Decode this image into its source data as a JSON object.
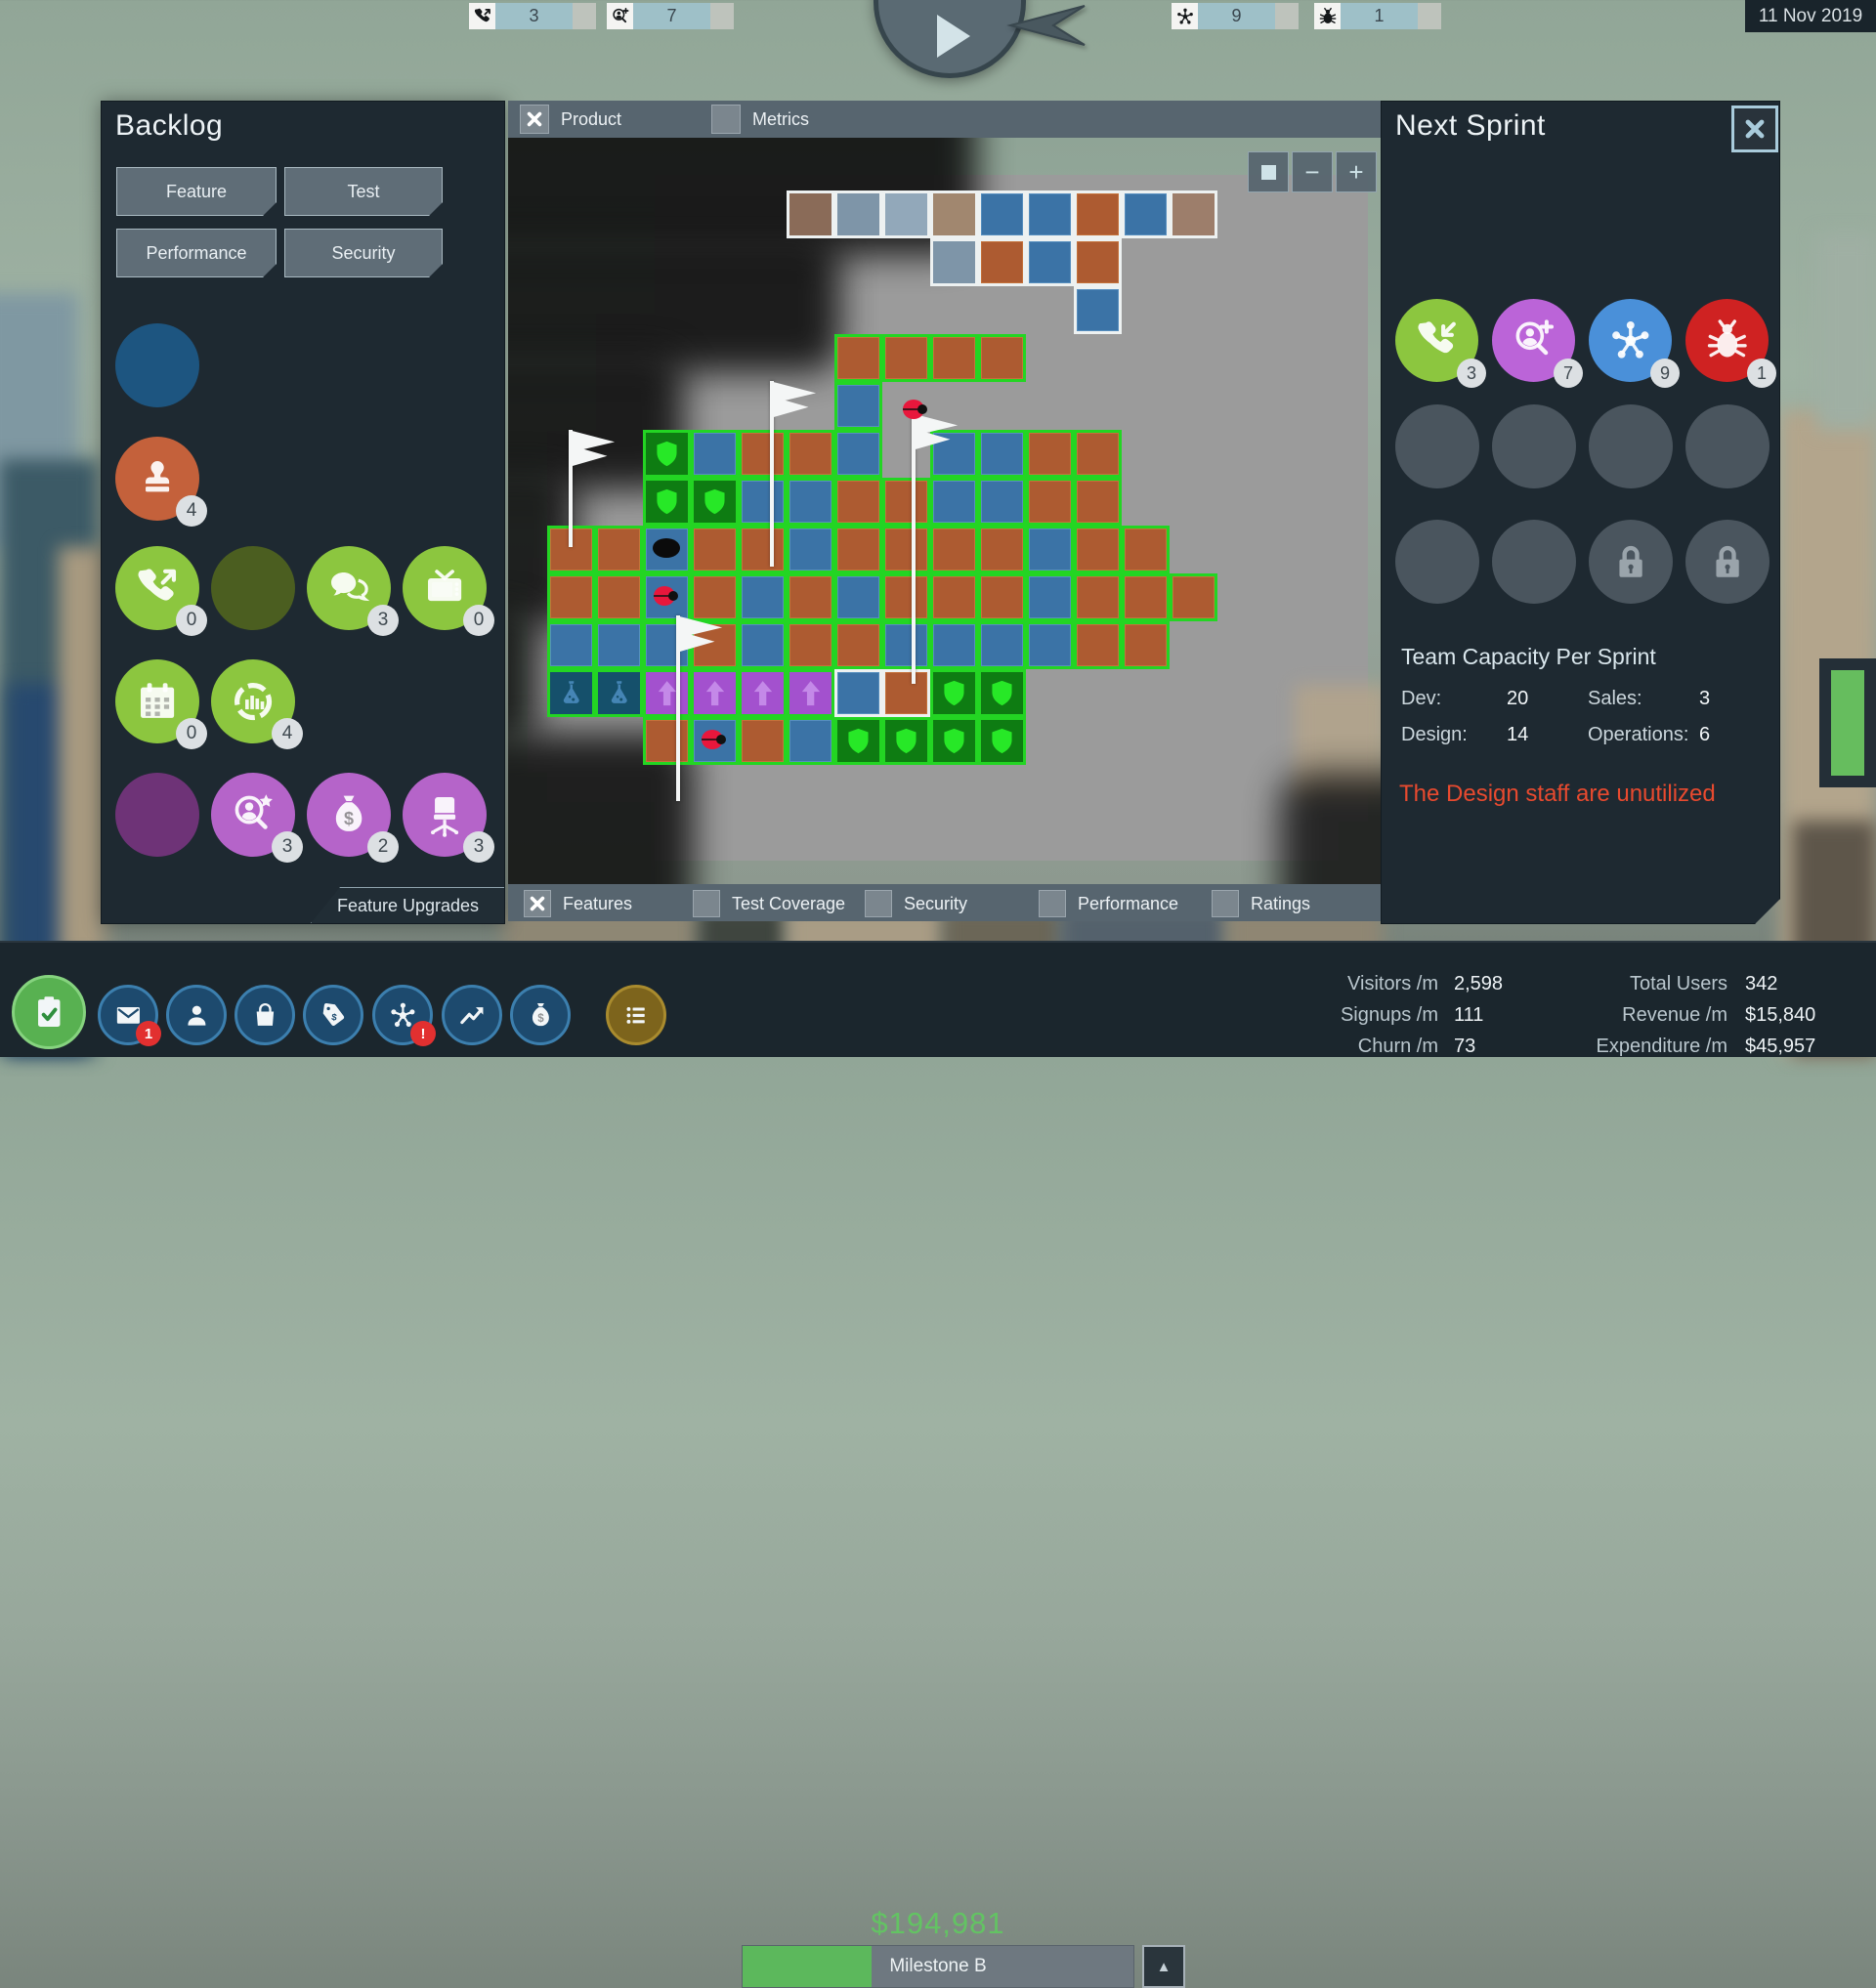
{
  "top_bar": {
    "date": "11 Nov 2019",
    "counters": [
      {
        "icon": "phone-out-icon",
        "value": "3"
      },
      {
        "icon": "person-add-icon",
        "value": "7"
      },
      {
        "icon": "network-icon",
        "value": "9"
      },
      {
        "icon": "bug-icon",
        "value": "1"
      }
    ]
  },
  "backlog": {
    "title": "Backlog",
    "buttons": [
      "Feature",
      "Test",
      "Performance",
      "Security"
    ],
    "rows": [
      [
        {
          "icon": "",
          "color": "#1D5580"
        }
      ],
      [
        {
          "icon": "stamp-icon",
          "color": "#C4613B",
          "badge": "4"
        }
      ],
      [
        {
          "icon": "phone-out-icon",
          "color": "#8CC63F",
          "badge": "0"
        },
        {
          "icon": "",
          "color": "#4B5E20"
        },
        {
          "icon": "chat-icon",
          "color": "#8CC63F",
          "badge": "3"
        },
        {
          "icon": "tv-icon",
          "color": "#8CC63F",
          "badge": "0"
        }
      ],
      [
        {
          "icon": "calendar-icon",
          "color": "#8CC63F",
          "badge": "0"
        },
        {
          "icon": "chart-icon",
          "color": "#8CC63F",
          "badge": "4"
        }
      ],
      [
        {
          "icon": "",
          "color": "#6E3377"
        },
        {
          "icon": "person-star-icon",
          "color": "#B564C9",
          "badge": "3"
        },
        {
          "icon": "moneybag-icon",
          "color": "#B564C9",
          "badge": "2"
        },
        {
          "icon": "chair-icon",
          "color": "#B564C9",
          "badge": "3"
        }
      ]
    ],
    "footer_tab": "Feature Upgrades"
  },
  "map": {
    "tabs": [
      {
        "label": "Product",
        "checked": true
      },
      {
        "label": "Metrics",
        "checked": false
      }
    ],
    "legend": [
      {
        "label": "Features",
        "checked": true
      },
      {
        "label": "Test Coverage",
        "checked": false
      },
      {
        "label": "Security",
        "checked": false
      },
      {
        "label": "Performance",
        "checked": false
      },
      {
        "label": "Ratings",
        "checked": false
      }
    ],
    "zoom_buttons": [
      "center",
      "minus",
      "plus"
    ],
    "grid": {
      "cell": 49,
      "ox": 40,
      "oy": 54,
      "white": [
        [
          5,
          0,
          "fbr"
        ],
        [
          6,
          0,
          "fbl"
        ],
        [
          7,
          0,
          "flb"
        ],
        [
          8,
          0,
          "ftn"
        ],
        [
          9,
          0,
          "bl"
        ],
        [
          10,
          0,
          "bl"
        ],
        [
          11,
          0,
          "br"
        ],
        [
          12,
          0,
          "bl"
        ],
        [
          13,
          0,
          "fb2"
        ],
        [
          8,
          1,
          "fbl"
        ],
        [
          9,
          1,
          "br"
        ],
        [
          10,
          1,
          "bl"
        ],
        [
          11,
          1,
          "br"
        ],
        [
          11,
          2,
          "bl"
        ],
        [
          6,
          10,
          "bl"
        ],
        [
          7,
          10,
          "br"
        ]
      ],
      "green": [
        [
          6,
          3,
          "br"
        ],
        [
          7,
          3,
          "br"
        ],
        [
          8,
          3,
          "br"
        ],
        [
          9,
          3,
          "br"
        ],
        [
          6,
          4,
          "bl"
        ],
        [
          2,
          5,
          "sh"
        ],
        [
          3,
          5,
          "bl"
        ],
        [
          4,
          5,
          "br"
        ],
        [
          5,
          5,
          "br"
        ],
        [
          6,
          5,
          "bl"
        ],
        [
          8,
          5,
          "bl"
        ],
        [
          9,
          5,
          "bl"
        ],
        [
          10,
          5,
          "br"
        ],
        [
          11,
          5,
          "br"
        ],
        [
          2,
          6,
          "sh"
        ],
        [
          3,
          6,
          "sh"
        ],
        [
          4,
          6,
          "bl"
        ],
        [
          5,
          6,
          "bl"
        ],
        [
          6,
          6,
          "br"
        ],
        [
          7,
          6,
          "br"
        ],
        [
          8,
          6,
          "bl"
        ],
        [
          9,
          6,
          "bl"
        ],
        [
          10,
          6,
          "br"
        ],
        [
          11,
          6,
          "br"
        ],
        [
          0,
          7,
          "br"
        ],
        [
          1,
          7,
          "br"
        ],
        [
          2,
          7,
          "bl"
        ],
        [
          3,
          7,
          "br"
        ],
        [
          4,
          7,
          "br"
        ],
        [
          5,
          7,
          "bl"
        ],
        [
          6,
          7,
          "br"
        ],
        [
          7,
          7,
          "br"
        ],
        [
          8,
          7,
          "br"
        ],
        [
          9,
          7,
          "br"
        ],
        [
          10,
          7,
          "bl"
        ],
        [
          11,
          7,
          "br"
        ],
        [
          12,
          7,
          "br"
        ],
        [
          0,
          8,
          "br"
        ],
        [
          1,
          8,
          "br"
        ],
        [
          2,
          8,
          "bl"
        ],
        [
          3,
          8,
          "br"
        ],
        [
          4,
          8,
          "bl"
        ],
        [
          5,
          8,
          "br"
        ],
        [
          6,
          8,
          "bl"
        ],
        [
          7,
          8,
          "br"
        ],
        [
          8,
          8,
          "br"
        ],
        [
          9,
          8,
          "br"
        ],
        [
          10,
          8,
          "bl"
        ],
        [
          11,
          8,
          "br"
        ],
        [
          12,
          8,
          "br"
        ],
        [
          13,
          8,
          "br"
        ],
        [
          0,
          9,
          "bl"
        ],
        [
          1,
          9,
          "bl"
        ],
        [
          2,
          9,
          "bl"
        ],
        [
          3,
          9,
          "br"
        ],
        [
          4,
          9,
          "bl"
        ],
        [
          5,
          9,
          "br"
        ],
        [
          6,
          9,
          "br"
        ],
        [
          7,
          9,
          "bl"
        ],
        [
          8,
          9,
          "bl"
        ],
        [
          9,
          9,
          "bl"
        ],
        [
          10,
          9,
          "bl"
        ],
        [
          11,
          9,
          "br"
        ],
        [
          12,
          9,
          "br"
        ],
        [
          0,
          10,
          "fl"
        ],
        [
          1,
          10,
          "fl"
        ],
        [
          2,
          10,
          "pu"
        ],
        [
          3,
          10,
          "pu"
        ],
        [
          4,
          10,
          "pu"
        ],
        [
          5,
          10,
          "pu"
        ],
        [
          8,
          10,
          "sh"
        ],
        [
          9,
          10,
          "sh"
        ],
        [
          2,
          11,
          "br"
        ],
        [
          3,
          11,
          "bl"
        ],
        [
          4,
          11,
          "br"
        ],
        [
          5,
          11,
          "bl"
        ],
        [
          6,
          11,
          "sh"
        ],
        [
          7,
          11,
          "sh"
        ],
        [
          8,
          11,
          "sh"
        ],
        [
          9,
          11,
          "sh"
        ]
      ],
      "flags": [
        [
          62,
          299,
          120
        ],
        [
          268,
          249,
          190
        ],
        [
          413,
          282,
          277
        ],
        [
          172,
          489,
          190
        ]
      ],
      "bugs": [
        [
          402,
          266
        ],
        [
          147,
          457
        ],
        [
          196,
          604
        ]
      ],
      "dots": [
        [
          148,
          410
        ]
      ]
    }
  },
  "next_sprint": {
    "title": "Next Sprint",
    "queue": [
      {
        "icon": "phone-in-icon",
        "color": "#8CC63F",
        "badge": "3"
      },
      {
        "icon": "person-add-icon",
        "color": "#BB64D8",
        "badge": "7"
      },
      {
        "icon": "network-icon",
        "color": "#4A90D9",
        "badge": "9"
      },
      {
        "icon": "bug-icon",
        "color": "#CF2222",
        "badge": "1"
      }
    ],
    "slots": [
      [
        "",
        "",
        "",
        ""
      ],
      [
        "",
        "",
        "lock-icon",
        "lock-icon"
      ]
    ],
    "capacity": {
      "title": "Team Capacity Per Sprint",
      "stats": [
        {
          "label": "Dev:",
          "value": "20"
        },
        {
          "label": "Sales:",
          "value": "3"
        },
        {
          "label": "Design:",
          "value": "14"
        },
        {
          "label": "Operations:",
          "value": "6"
        }
      ]
    },
    "warning": "The Design staff are unutilized"
  },
  "bottom_bar": {
    "money": "$194,981",
    "milestone": {
      "label": "Milestone B",
      "progress": 0.33
    },
    "up_button": "▲",
    "nav": [
      {
        "icon": "clipboard-icon",
        "color": "#58B151",
        "ring": "#86D37F",
        "big": true
      },
      {
        "icon": "mail-icon",
        "color": "#1D4A6E",
        "ring": "#3C7FAE",
        "badge": "1"
      },
      {
        "icon": "person-icon",
        "color": "#1D4A6E",
        "ring": "#3C7FAE"
      },
      {
        "icon": "bag-icon",
        "color": "#1D4A6E",
        "ring": "#3C7FAE"
      },
      {
        "icon": "tag-icon",
        "color": "#1D4A6E",
        "ring": "#3C7FAE"
      },
      {
        "icon": "network-icon",
        "color": "#1D4A6E",
        "ring": "#3C7FAE",
        "badge": "!"
      },
      {
        "icon": "trend-icon",
        "color": "#1D4A6E",
        "ring": "#3C7FAE"
      },
      {
        "icon": "moneybag-icon",
        "color": "#1D4A6E",
        "ring": "#3C7FAE"
      },
      {
        "icon": "list-icon",
        "color": "#7D641C",
        "ring": "#A98B2E"
      }
    ],
    "stats_left": [
      {
        "label": "Visitors /m",
        "value": "2,598"
      },
      {
        "label": "Signups /m",
        "value": "111"
      },
      {
        "label": "Churn /m",
        "value": "73"
      }
    ],
    "stats_right": [
      {
        "label": "Total Users",
        "value": "342"
      },
      {
        "label": "Revenue /m",
        "value": "$15,840"
      },
      {
        "label": "Expenditure /m",
        "value": "$45,957"
      }
    ]
  }
}
